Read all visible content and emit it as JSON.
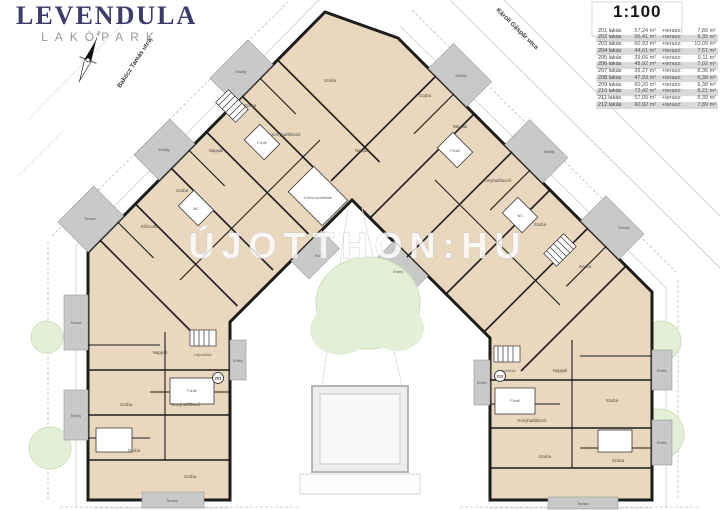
{
  "branding": {
    "title": "LEVENDULA",
    "subtitle": "LAKÓPARK"
  },
  "scale": "1:100",
  "streets": {
    "left": "Bakócz Tamás utca",
    "right": "Károli Gáspár utca"
  },
  "compass": {
    "north": "É"
  },
  "watermark": "ÚJOTTHON:HU",
  "legend_table": {
    "terasz_label": "+terasz:",
    "rows": [
      {
        "num": "201",
        "name": "201 lakás",
        "area": "57,24 m²",
        "terrace": "7,89 m²"
      },
      {
        "num": "202",
        "name": "202 lakás",
        "area": "56,41 m²",
        "terrace": "9,35 m²"
      },
      {
        "num": "203",
        "name": "203 lakás",
        "area": "60,93 m²",
        "terrace": "10,09 m²"
      },
      {
        "num": "204",
        "name": "204 lakás",
        "area": "44,61 m²",
        "terrace": "7,51 m²"
      },
      {
        "num": "205",
        "name": "205 lakás",
        "area": "39,66 m²",
        "terrace": "6,11 m²"
      },
      {
        "num": "206",
        "name": "206 lakás",
        "area": "48,92 m²",
        "terrace": "7,02 m²"
      },
      {
        "num": "207",
        "name": "207 lakás",
        "area": "39,27 m²",
        "terrace": "8,36 m²"
      },
      {
        "num": "208",
        "name": "208 lakás",
        "area": "47,93 m²",
        "terrace": "6,38 m²"
      },
      {
        "num": "209",
        "name": "209 lakás",
        "area": "60,20 m²",
        "terrace": "6,38 m²"
      },
      {
        "num": "210",
        "name": "210 lakás",
        "area": "72,42 m²",
        "terrace": "8,21 m²"
      },
      {
        "num": "211",
        "name": "211 lakás",
        "area": "57,09 m²",
        "terrace": "8,39 m²"
      },
      {
        "num": "212",
        "name": "212 lakás",
        "area": "60,92 m²",
        "terrace": "7,89 m²"
      }
    ]
  },
  "plan": {
    "labels": {
      "szoba": "Szoba",
      "nappali": "Nappali",
      "konyha": "Konyha/Étkező",
      "furdo": "Fürdő",
      "eloszoba": "Előszoba",
      "erkely": "Erkély",
      "terasz": "Terasz",
      "wc": "WC",
      "lepcsohaz": "Lépcsőház",
      "kozlekedo": "Közös közlekedő"
    },
    "markers": {
      "left": "201",
      "right": "212"
    },
    "colors": {
      "room": "#e9d8bd",
      "terrace": "#c9c9c9",
      "wall": "#1c1c1c",
      "tree": "#e4efd8",
      "accent": "#3d3c6e"
    }
  }
}
